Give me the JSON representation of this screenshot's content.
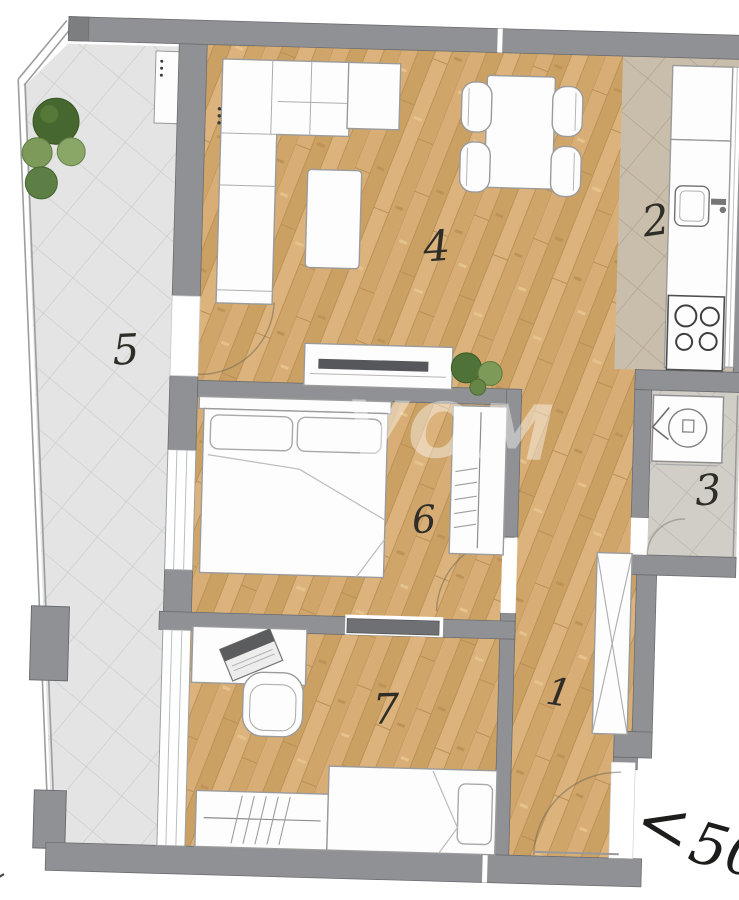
{
  "plan_title": "apartment-floor-plan",
  "watermark": "VOM",
  "rooms": [
    {
      "id": "hallway",
      "label": "1"
    },
    {
      "id": "kitchen",
      "label": "2"
    },
    {
      "id": "bathroom",
      "label": "3"
    },
    {
      "id": "living-dining",
      "label": "4"
    },
    {
      "id": "terrace",
      "label": "5"
    },
    {
      "id": "bedroom",
      "label": "6"
    },
    {
      "id": "kids-room",
      "label": "7"
    }
  ],
  "dimension_note": {
    "chevron": "<",
    "value": "50"
  },
  "colors": {
    "wall": "#8f9194",
    "wall_dark": "#7c7e80",
    "door_leaf": "#6e7073",
    "wood_floor": "#d2a76e",
    "terrace_tile": "#e3e4e3",
    "kitchen_tile": "#c9beac",
    "bath_tile": "#d1cec7",
    "furniture_fill": "#fdfdfd",
    "furniture_stroke": "#9b9b9b",
    "plant_dark": "#46672f",
    "plant_light": "#7d9a58",
    "label_ink": "#2e2d28",
    "tv_screen": "#55575a"
  }
}
